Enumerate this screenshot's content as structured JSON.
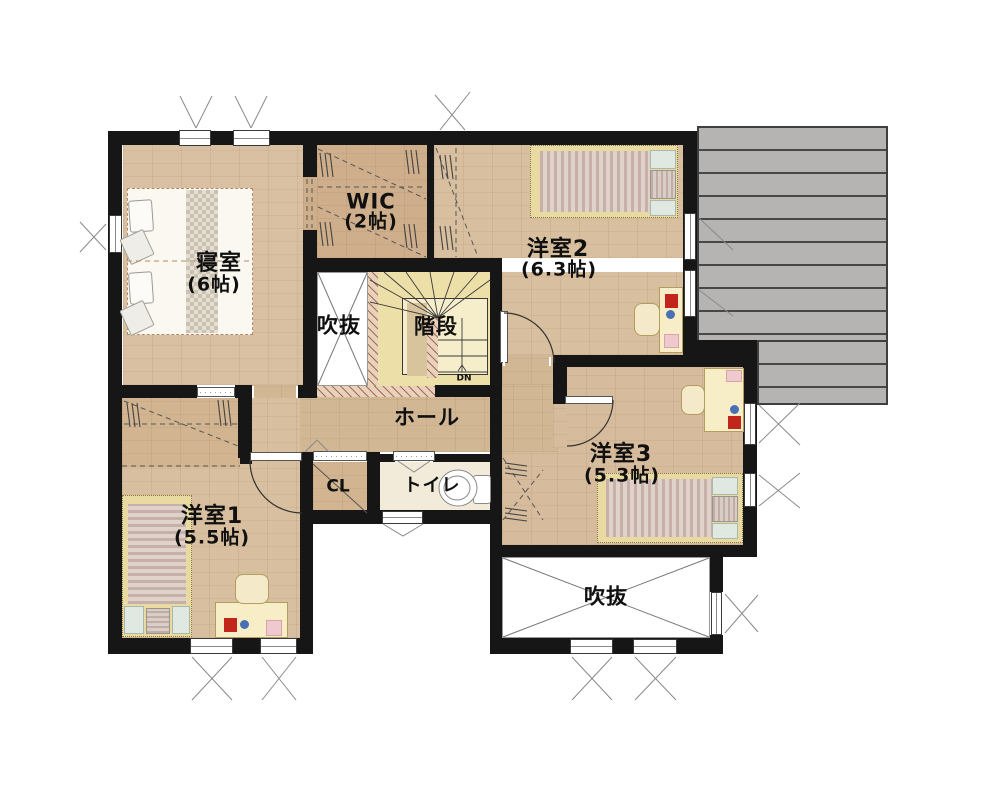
{
  "rooms": {
    "bedroom": {
      "name": "寝室",
      "size": "(6帖)"
    },
    "wic": {
      "name": "WIC",
      "size": "(2帖)"
    },
    "youshitsu2": {
      "name": "洋室2",
      "size": "(6.3帖)"
    },
    "youshitsu1": {
      "name": "洋室1",
      "size": "(5.5帖)"
    },
    "youshitsu3": {
      "name": "洋室3",
      "size": "(5.3帖)"
    },
    "hall": {
      "name": "ホール"
    },
    "stairs": {
      "name": "階段",
      "down": "DN"
    },
    "void_center": {
      "name": "吹抜"
    },
    "void_bottom": {
      "name": "吹抜"
    },
    "closet": {
      "name": "CL"
    },
    "toilet": {
      "name": "トイレ"
    }
  },
  "colors": {
    "wall": "#161616",
    "wood_floor": "#d8bf9f",
    "wic_floor": "#cfae8b",
    "hall_floor": "#d2b795",
    "toilet_floor": "#f3ebda",
    "stairs_fill": "#ece0a8",
    "deck_gray": "#b5b4b2",
    "void_white": "#ffffff",
    "bed_frame": "#e9daa1",
    "mattress_stripe": "#c6b0a8",
    "accent_red": "#c2251c",
    "accent_blue": "#4a6fb5",
    "accent_pink": "#eecace",
    "accent_teal": "#dfe8e1"
  }
}
